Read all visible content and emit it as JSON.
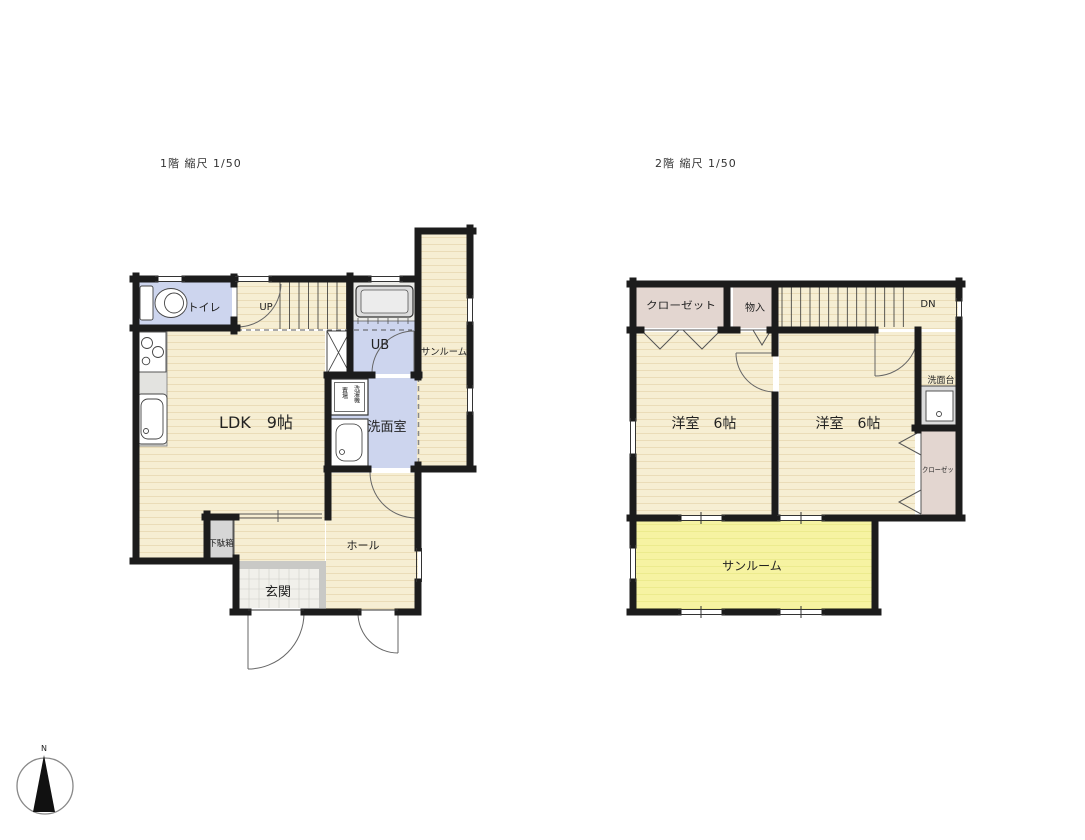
{
  "floor1": {
    "title": "1階 縮尺 1/50",
    "labels": {
      "toilet": "トイレ",
      "stairs": "UP",
      "bath": "UB",
      "sunroom": "サンルーム",
      "ldk": "LDK　9帖",
      "washroom": "洗面室",
      "laundry_col1": "洗濯機",
      "laundry_col2": "置場",
      "shoe_cabinet": "下駄箱",
      "hall": "ホール",
      "entrance": "玄関"
    }
  },
  "floor2": {
    "title": "2階 縮尺 1/50",
    "labels": {
      "closet_top": "クローゼット",
      "storage": "物入",
      "stairs": "DN",
      "vanity": "洗面台",
      "closet_right": "クローゼット",
      "bedroom_left": "洋室　6帖",
      "bedroom_right": "洋室　6帖",
      "sunroom": "サンルーム"
    }
  },
  "compass": {
    "label": "N"
  },
  "colors": {
    "wall": "#1c1c1c",
    "floor_wood": "#f6eed3",
    "floor_wood_line": "#eadcb8",
    "floor_wet": "#cdd5ee",
    "floor_sun2": "#f6f3a2",
    "closet": "#e3d6d0",
    "fixture_gray": "#dcdcdc",
    "tile": "#f1f0eb",
    "tub_floor": "#ebebe8"
  }
}
